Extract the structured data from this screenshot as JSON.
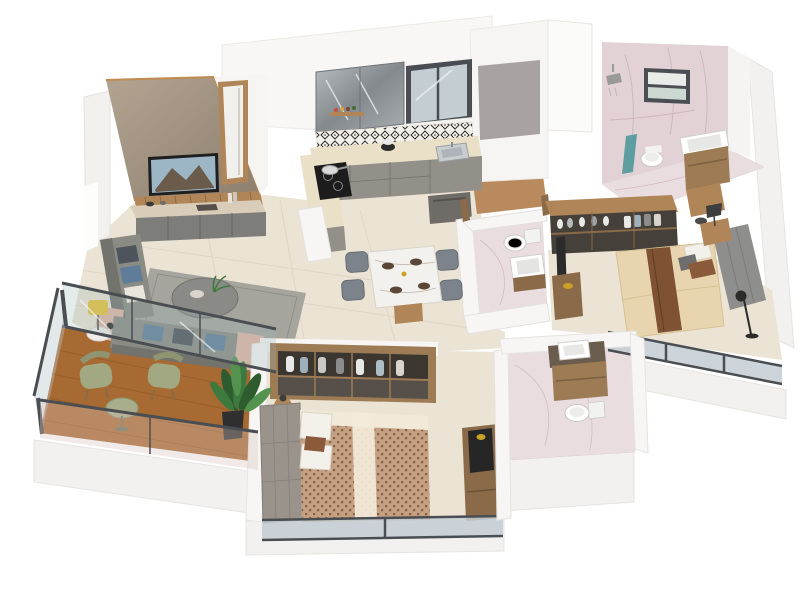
{
  "scene": {
    "type": "isometric-3d-floor-plan-render",
    "description": "3D isometric cutaway render of a 2BHK apartment",
    "rooms": [
      "living-room",
      "dining-area",
      "kitchen",
      "utility",
      "powder-toilet",
      "master-bathroom",
      "master-bedroom",
      "bedroom-2",
      "bathroom-2",
      "balcony"
    ]
  },
  "palette": {
    "background": "#ffffff",
    "wall_white": "#f7f6f4",
    "wall_bright": "#fdfdfc",
    "wall_edge": "#e3e1dd",
    "slab": "#f2f1ef",
    "floor_tile": "#ebe3d3",
    "grout": "#d9cebb",
    "feature_wall": "#a4968300",
    "feature_light": "#b3a492",
    "feature_dark": "#8d7f6d",
    "copper_trim": "#c08a50",
    "wood": "#b08558",
    "wood_dark": "#8a6a48",
    "wood_frame": "#9c7b55",
    "tv_frame": "#1f1f1f",
    "tv_sky": "#9db6c6",
    "tv_mountain": "#6b5b4a",
    "console_grey": "#7d7d7a",
    "console_top": "#d9cdb9",
    "sofa_grey": "#8b8b85",
    "sofa_dark": "#73736d",
    "cushion_blue": "#5f7d99",
    "cushion_dark": "#4e545b",
    "cushion_white": "#e9e5db",
    "blush": "#e0b4a6",
    "rug": "#a1a19b",
    "olive": "#a2a881",
    "olive_dark": "#8f9570",
    "deck_wood": "#a86a33",
    "deck_line": "#8a541f",
    "plant_dark": "#2e5c2e",
    "plant_mid": "#3e7a3e",
    "plant_light": "#54934f",
    "counter_top": "#eadfc7",
    "cabinet_grey": "#93908a",
    "cabinet_dark": "#6f6c68",
    "hob_black": "#1c1c1c",
    "steel": "#c9cdd0",
    "backsplash_bg": "#f4f0ea",
    "backsplash_ink": "#2e2e2e",
    "window_frame": "#4a4e52",
    "glass": "#c3cdd2",
    "glass_teal": "#9fb6b6",
    "grey_panel": "#a9a2a2",
    "pink_wall": "#e2d2d5",
    "pink_floor": "#eadde0",
    "marble_vein": "#c9aeb4",
    "utility_floor": "#b98a5e",
    "fixture_white": "#ffffff",
    "fixture_shadow": "#d0cfcd",
    "towel_teal": "#5f9ea0",
    "crockery_dark": "#46403a",
    "wardrobe_dark": "#3c3631",
    "wardrobe_lower": "#57504a",
    "bed_cream": "#e8d5b0",
    "runner_brown": "#7e5233",
    "pillow_brown": "#8a5a3a",
    "headboard_grey": "#8e8e8c",
    "headboard2": "#9a938c",
    "duvet_base": "#c4a083",
    "duvet_dot": "#8a5f46",
    "sheet_white": "#f2ead9",
    "lamp_yellow": "#e8c23a",
    "gold": "#c9a227",
    "marble_table": "#f3f1ed",
    "chair_grey": "#7d838a",
    "plate_dark": "#5a4636",
    "granite": "#6b5d4d"
  }
}
